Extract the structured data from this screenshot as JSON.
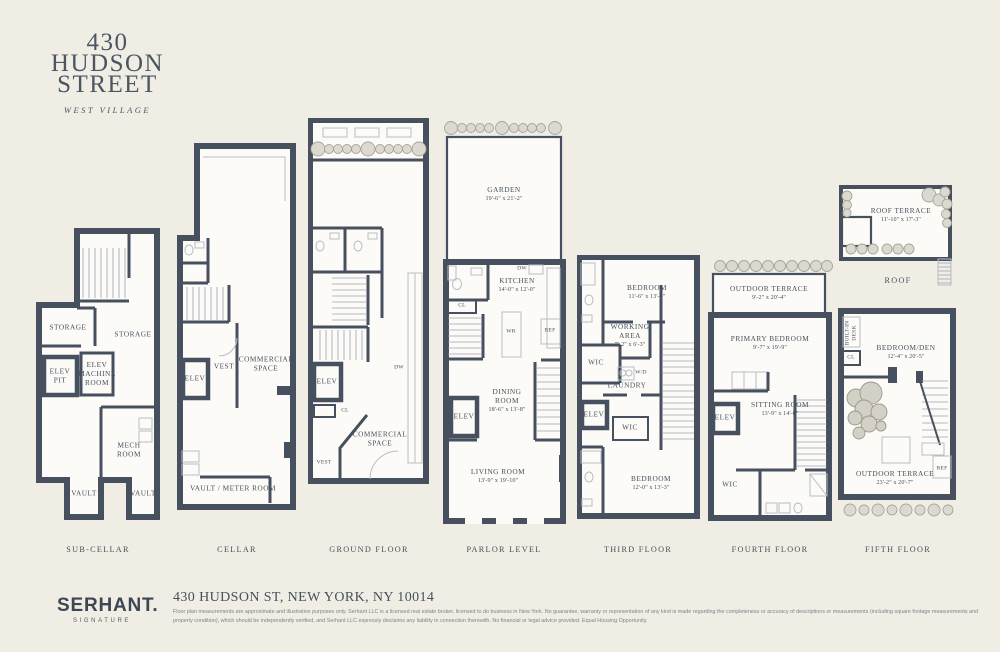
{
  "header": {
    "line1": "430",
    "line2": "HUDSON",
    "line3": "STREET",
    "neighborhood": "WEST VILLAGE"
  },
  "colors": {
    "background": "#f0ede4",
    "wall": "#47505e",
    "floor": "#fcfbf7",
    "shrub": "#dcd9d0"
  },
  "floors": [
    {
      "label": "SUB-CELLAR",
      "rooms": [
        {
          "name": "STORAGE"
        },
        {
          "name": "STORAGE"
        },
        {
          "name": "ELEV PIT"
        },
        {
          "name": "ELEV MACHINE ROOM"
        },
        {
          "name": "MECH ROOM"
        },
        {
          "name": "VAULT"
        },
        {
          "name": "VAULT"
        }
      ]
    },
    {
      "label": "CELLAR",
      "rooms": [
        {
          "name": "ELEV"
        },
        {
          "name": "VEST"
        },
        {
          "name": "COMMERCIAL SPACE"
        },
        {
          "name": "VAULT / METER ROOM"
        }
      ]
    },
    {
      "label": "GROUND FLOOR",
      "rooms": [
        {
          "name": "ELEV"
        },
        {
          "name": "CL"
        },
        {
          "name": "VEST"
        },
        {
          "name": "DW"
        },
        {
          "name": "COMMERCIAL SPACE"
        }
      ]
    },
    {
      "label": "PARLOR LEVEL",
      "rooms": [
        {
          "name": "GARDEN",
          "dims": "19'-6\" x 21'-2\""
        },
        {
          "name": "KITCHEN",
          "dims": "14'-0\" x 12'-0\""
        },
        {
          "name": "DW"
        },
        {
          "name": "WR"
        },
        {
          "name": "REF"
        },
        {
          "name": "CL"
        },
        {
          "name": "DINING ROOM",
          "dims": "18'-6\" x 13'-8\""
        },
        {
          "name": "ELEV"
        },
        {
          "name": "LIVING ROOM",
          "dims": "13'-9\" x 19'-10\""
        }
      ]
    },
    {
      "label": "THIRD FLOOR",
      "rooms": [
        {
          "name": "BEDROOM",
          "dims": "11'-6\" x 13'-4\""
        },
        {
          "name": "WORKING AREA",
          "dims": "7'-2\" x 6'-3\""
        },
        {
          "name": "WIC"
        },
        {
          "name": "W/D"
        },
        {
          "name": "LAUNDRY"
        },
        {
          "name": "ELEV"
        },
        {
          "name": "WIC"
        },
        {
          "name": "BEDROOM",
          "dims": "12'-0\" x 13'-3\""
        }
      ]
    },
    {
      "label": "FOURTH FLOOR",
      "rooms": [
        {
          "name": "OUTDOOR TERRACE",
          "dims": "9'-2\" x 20'-4\""
        },
        {
          "name": "PRIMARY BEDROOM",
          "dims": "9'-7\" x 19'-9\""
        },
        {
          "name": "ELEV"
        },
        {
          "name": "SITTING ROOM",
          "dims": "13'-9\" x 14'-0\""
        },
        {
          "name": "WIC"
        }
      ]
    },
    {
      "label": "FIFTH FLOOR",
      "rooms": [
        {
          "name": "BUILT-IN DESK"
        },
        {
          "name": "CL"
        },
        {
          "name": "BEDROOM/DEN",
          "dims": "12'-4\" x 20'-5\""
        },
        {
          "name": "OUTDOOR TERRACE",
          "dims": "23'-2\" x 20'-7\""
        },
        {
          "name": "REF"
        }
      ]
    },
    {
      "label": "ROOF",
      "rooms": [
        {
          "name": "ROOF TERRACE",
          "dims": "11'-10\" x 17'-3\""
        }
      ]
    }
  ],
  "footer": {
    "brand": "SERHANT.",
    "brand_sub": "SIGNATURE",
    "address": "430 HUDSON ST, NEW YORK, NY 10014",
    "disclaimer": "Floor plan measurements are approximate and illustrative purposes only. Serhant LLC is a licensed real estate broker, licensed to do business in New York. No guarantee, warranty or representation of any kind is made regarding the completeness or accuracy of descriptions or measurements (including square footage measurements and property condition), which should be independently verified, and Serhant LLC expressly disclaims any liability in connection therewith. No financial or legal advice provided. Equal Housing Opportunity."
  }
}
